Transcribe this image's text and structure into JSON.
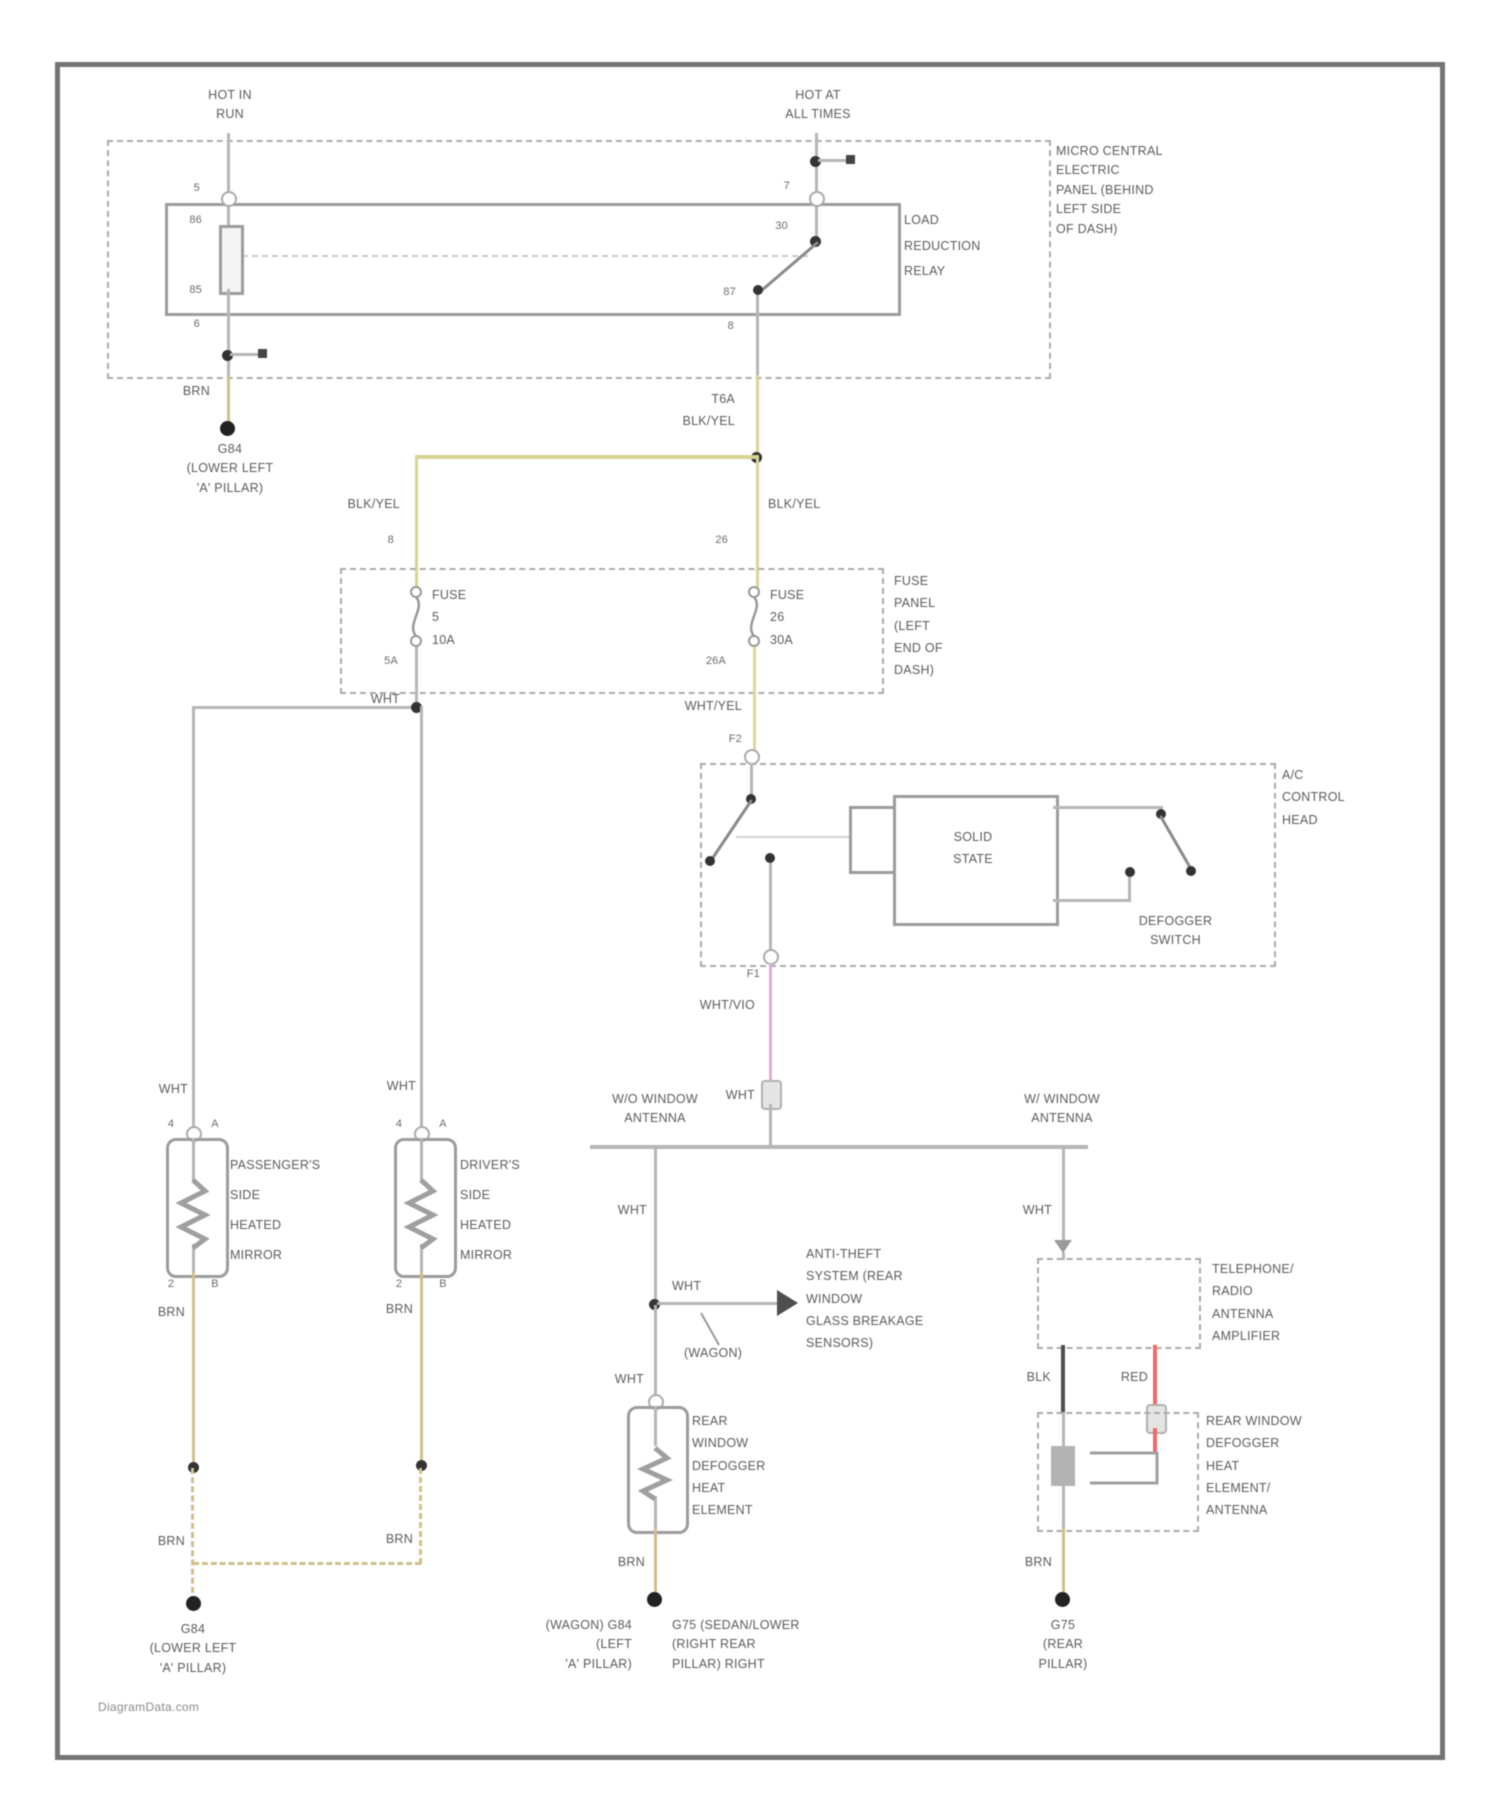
{
  "colors": {
    "wht": "#b6b6b6",
    "brn": "#cfc08b",
    "blkyel": "#d8d494",
    "whtyel": "#ded998",
    "vio": "#dfadd9",
    "red": "#ef6a6a",
    "blk": "#4f4f4f"
  },
  "watermark": "DiagramData.com",
  "feeds": {
    "hot_in_run": "HOT IN\nRUN",
    "hot_at_all_times": "HOT AT\nALL TIMES"
  },
  "central_panel": {
    "label": "MICRO CENTRAL\nELECTRIC\nPANEL (BEHIND\nLEFT SIDE\nOF DASH)",
    "relay_label": "LOAD\nREDUCTION\nRELAY",
    "pins": {
      "coil_top": "86",
      "coil_bottom": "85",
      "contact_top": "30",
      "contact_bottom": "87",
      "ext_top_left": "5",
      "ext_bottom_left": "6",
      "ext_top_right": "7",
      "ext_bottom_right": "8"
    }
  },
  "fuse_panel": {
    "label": "FUSE\nPANEL\n(LEFT\nEND OF\nDASH)",
    "fuse_left": "FUSE\n5\n10A",
    "fuse_right": "FUSE\n26\n30A",
    "pin_top_left": "8",
    "pin_top_right": "26",
    "pin_bottom_left": "5A",
    "pin_bottom_right": "26A"
  },
  "ac_head": {
    "label": "A/C\nCONTROL\nHEAD",
    "solid_state": "SOLID\nSTATE",
    "defogger_switch": "DEFOGGER\nSWITCH",
    "pin_in": "F2",
    "pin_out": "F1"
  },
  "mirrors": {
    "passenger": "PASSENGER'S\nSIDE\nHEATED\nMIRROR",
    "driver": "DRIVER'S\nSIDE\nHEATED\nMIRROR",
    "pin_top_left": "4",
    "pin_top_right": "A",
    "pin_bottom_left": "2",
    "pin_bottom_right": "B"
  },
  "antenna": {
    "without": "W/O WINDOW\nANTENNA",
    "with": "W/ WINDOW\nANTENNA",
    "amplifier": "TELEPHONE/\nRADIO\nANTENNA\nAMPLIFIER",
    "element_antenna": "REAR WINDOW\nDEFOGGER\nHEAT\nELEMENT/\nANTENNA"
  },
  "rear_defogger": {
    "element": "REAR\nWINDOW\nDEFOGGER\nHEAT\nELEMENT"
  },
  "anti_theft": {
    "label": "ANTI-THEFT\nSYSTEM (REAR\nWINDOW\nGLASS BREAKAGE\nSENSORS)",
    "variant_note": "(WAGON)"
  },
  "grounds": {
    "top_left": "G84\n(LOWER LEFT\n'A' PILLAR)",
    "bottom_left": "G84\n(LOWER LEFT\n'A' PILLAR)",
    "center_left": "(WAGON)   G84\n(LEFT\n'A' PILLAR)",
    "center_right": "G75   (SEDAN/LOWER\n(RIGHT REAR\nPILLAR) RIGHT",
    "rear": "G75\n(REAR\nPILLAR)"
  },
  "wire_labels": {
    "brn": "BRN",
    "wht": "WHT",
    "blk_yel": "BLK/YEL",
    "wht_yel": "WHT/YEL",
    "wht_vio": "WHT/VIO",
    "t6a": "T6A",
    "blk": "BLK",
    "red": "RED"
  }
}
